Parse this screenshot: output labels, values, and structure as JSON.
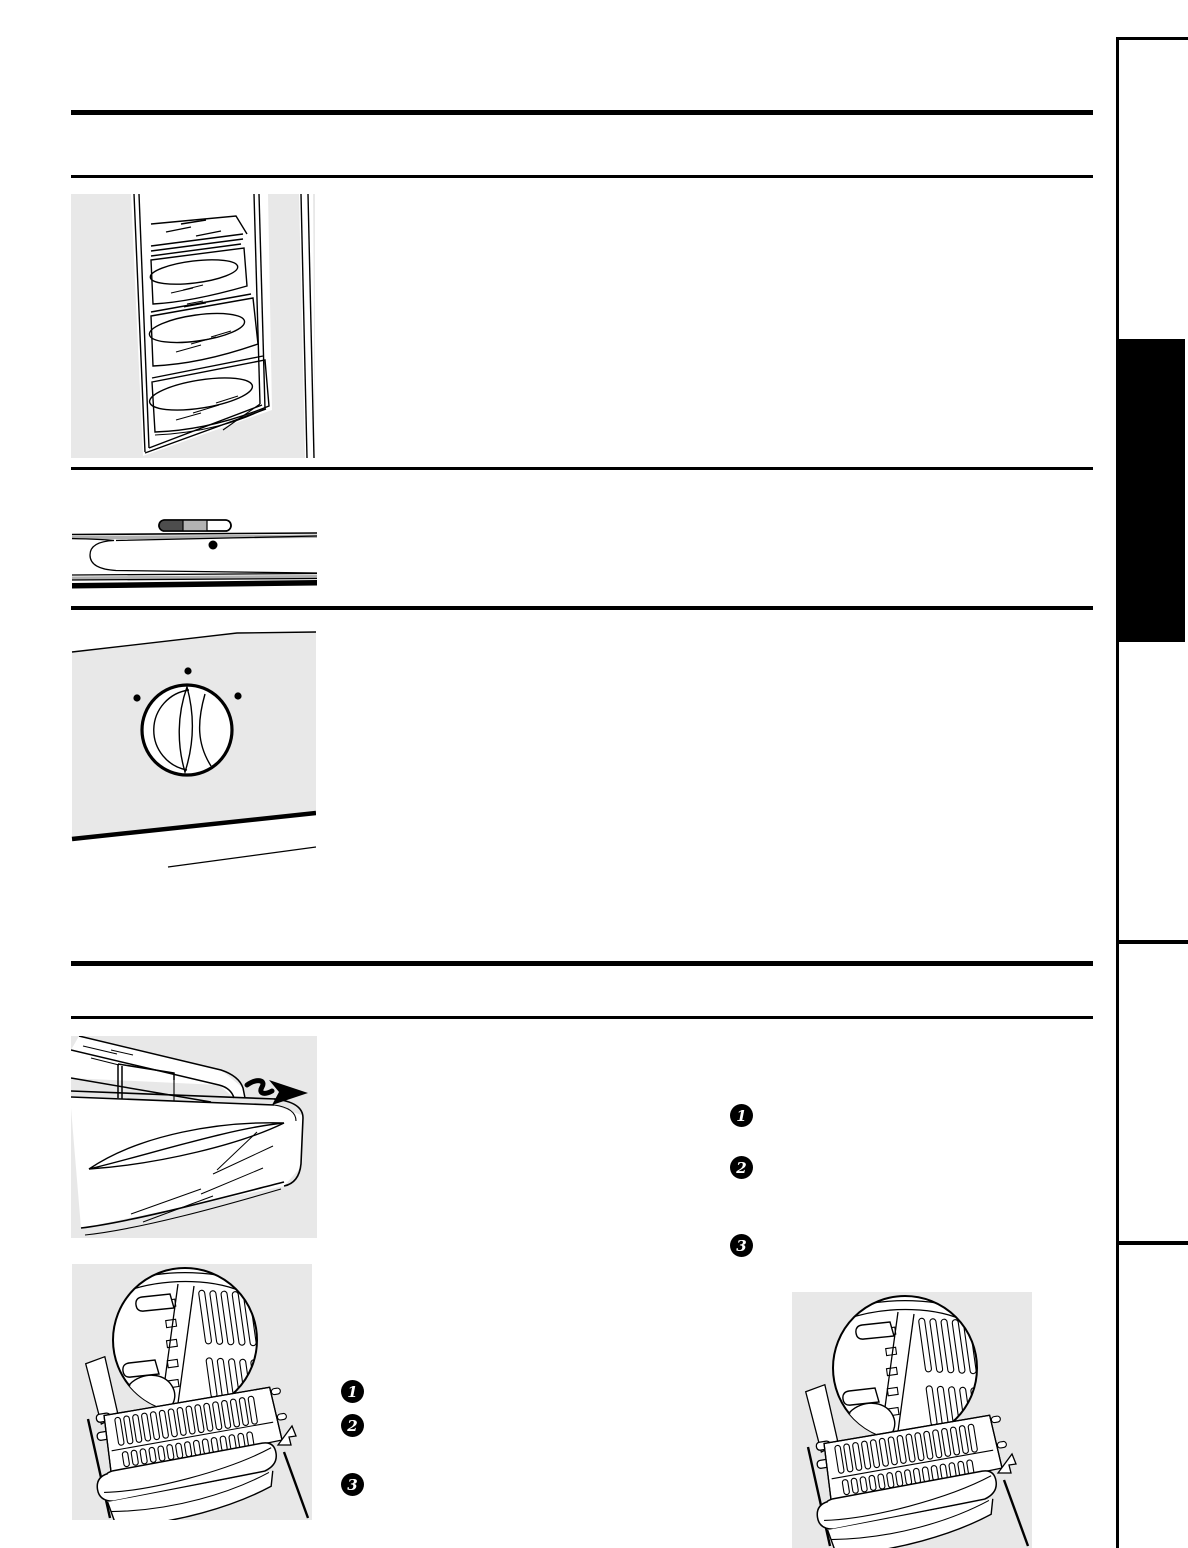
{
  "page": {
    "background_color": "#ffffff",
    "rule_color": "#000000",
    "illustration_background": "#e8e8e8"
  },
  "right_sidebar": {
    "divider_color": "#000000",
    "section_tab_color": "#000000"
  },
  "illustrations": {
    "freezer_door_bins": {
      "name": "freezer-door-bins-illustration"
    },
    "freezer_temperature_slider": {
      "name": "freezer-temperature-slider-illustration"
    },
    "temperature_control_knob": {
      "name": "temperature-control-knob-illustration"
    },
    "crisper_drawer_removal": {
      "name": "crisper-drawer-removal-illustration"
    },
    "drawer_support_detail_left": {
      "name": "drawer-support-detail-illustration"
    },
    "drawer_support_detail_right": {
      "name": "drawer-support-detail-illustration"
    }
  },
  "slider_control": {
    "segment_colors": [
      "#4d4d4d",
      "#b3b3b3",
      "#ffffff"
    ],
    "indicator_dot_color": "#000000"
  },
  "step_markers_main": {
    "items": [
      {
        "label": "1"
      },
      {
        "label": "2"
      },
      {
        "label": "3"
      }
    ]
  },
  "step_markers_detail": {
    "items": [
      {
        "label": "1"
      },
      {
        "label": "2"
      },
      {
        "label": "3"
      }
    ]
  }
}
